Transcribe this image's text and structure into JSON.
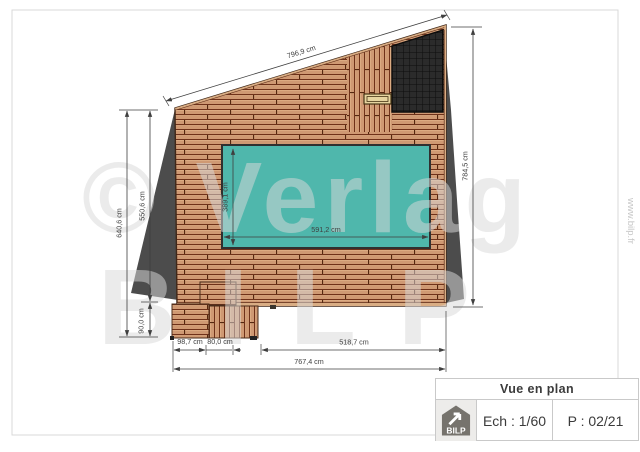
{
  "theme": {
    "wood": "#cf9973",
    "wood-gap": "#6f3119",
    "wood-joint": "#54270f",
    "wood-rim": "#d9ad84",
    "pool": "#4fb7ac",
    "pool-border": "#303030",
    "shadow": "#4c4c4c",
    "panel": "#2b2b2b",
    "panel-grid": "#0e0e0e",
    "bench": "#e6d49f",
    "bench-border": "#473415",
    "dim": "#3f3f3f",
    "watermark": "#d8d8d8",
    "frame": "#d9d9d9",
    "outline": "#3f2718"
  },
  "drawing": {
    "dims": {
      "top": "796,9 cm",
      "right": "784,5 cm",
      "left_total": "640,6 cm",
      "left_upper": "550,6 cm",
      "left_lower": "90,0 cm",
      "pool_width": "591,2 cm",
      "pool_depth": "389,1 cm",
      "bottom_seg1": "98,7 cm",
      "bottom_seg2": "80,0 cm",
      "bottom_seg3": "518,7 cm",
      "bottom_total": "767,4 cm"
    },
    "watermark": {
      "line1": "© Verlag",
      "line2": "BILP",
      "url_vertical": "www.bilp.fr"
    }
  },
  "title_block": {
    "title": "Vue en plan",
    "logo": "BILP",
    "scale": "Ech : 1/60",
    "page": "P : 02/21"
  }
}
